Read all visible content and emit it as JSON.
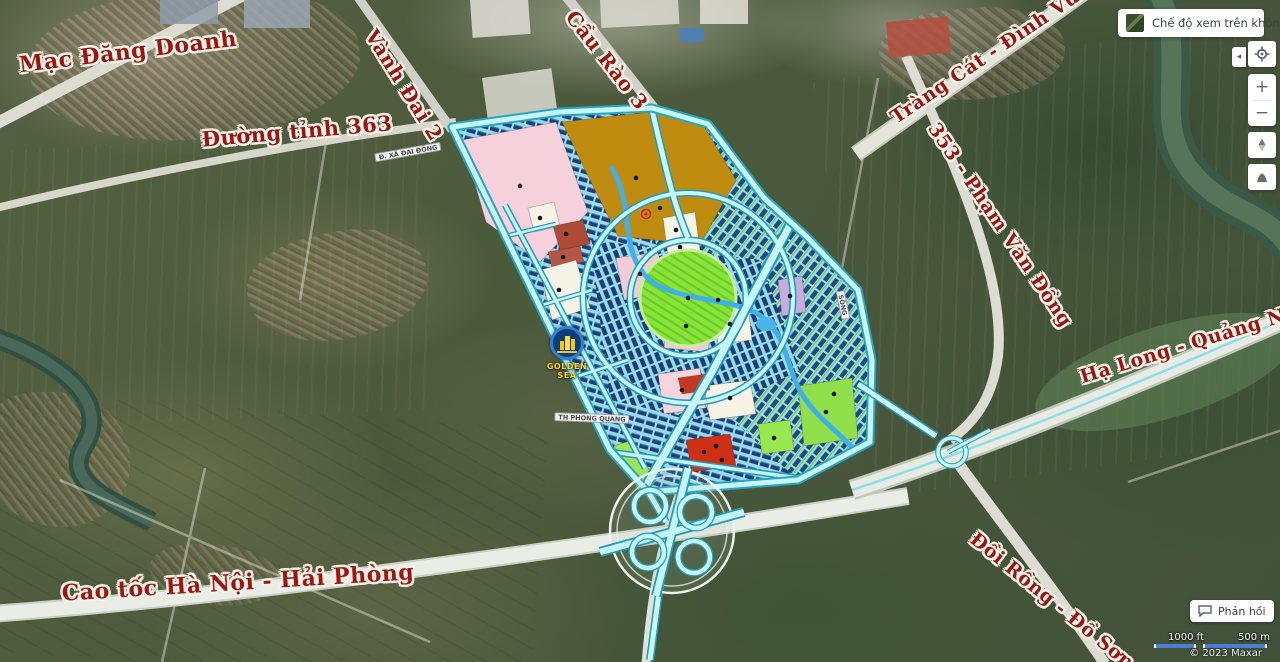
{
  "aerial_toggle": {
    "label": "Chế độ xem trên không"
  },
  "map_controls": {
    "collapse_glyph": "◂",
    "zoom_in_glyph": "+",
    "zoom_out_glyph": "−"
  },
  "feedback": {
    "label": "Phản hồi"
  },
  "scale_bar": {
    "imperial": "1000 ft",
    "metric": "500 m"
  },
  "attribution": "© 2023 Maxar",
  "project_logo": {
    "name": "GOLDEN SEA"
  },
  "road_labels": [
    {
      "text": "Mạc Đăng Doanh"
    },
    {
      "text": "Đường tỉnh 363"
    },
    {
      "text": "Vành Đai 2"
    },
    {
      "text": "Cầu Rào 3"
    },
    {
      "text": "Tràng Cát - Đình Vũ"
    },
    {
      "text": "353 - Phạm Văn Đồng"
    },
    {
      "text": "Hạ Long - Quảng Ninh"
    },
    {
      "text": "Cao tốc Hà Nội - Hải Phòng"
    },
    {
      "text": "Đồi Rồng - Đồ Sơn"
    }
  ],
  "minor_road_labels": [
    {
      "text": "Đ. XÃ ĐẠI ĐỒNG"
    },
    {
      "text": "TH PHONG QUANG"
    },
    {
      "text": "SÔNG"
    }
  ],
  "colors": {
    "label_red": "#9c1510",
    "planned_road_cyan": "#c9f6fa",
    "scale_bar_blue": "#4a7fd4",
    "logo_blue": "#2f80d0",
    "logo_yellow": "#f6c815"
  }
}
